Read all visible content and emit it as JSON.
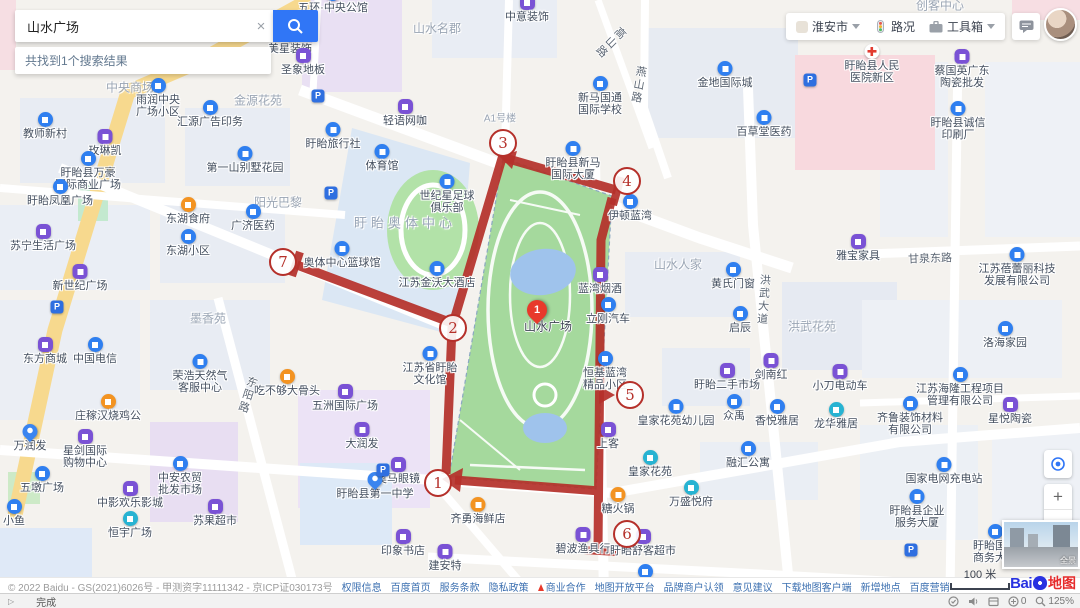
{
  "search": {
    "query": "山水广场",
    "clear_icon": "×",
    "results_text": "共找到1个搜索结果"
  },
  "topbar": {
    "city": "淮安市",
    "traffic_label": "路况",
    "toolbox_label": "工具箱"
  },
  "controls": {
    "zoom_in": "+",
    "zoom_out": "−",
    "scale_label": "100 米",
    "pano_label": "全景"
  },
  "logo": {
    "bai": "Bai",
    "ditu": "地图"
  },
  "map": {
    "pin": {
      "n": "1",
      "label": "山水广场"
    },
    "pois": [
      {
        "x": 333,
        "y": 7,
        "l": [
          "五环·中央公馆"
        ],
        "ic": "b"
      },
      {
        "x": 296,
        "y": 36,
        "l": [
          "皇家门窗"
        ],
        "ic": "t"
      },
      {
        "x": 527,
        "y": 16,
        "l": [
          "中意装饰"
        ],
        "ic": "p"
      },
      {
        "x": 290,
        "y": 48,
        "l": [
          "美星装饰"
        ],
        "ic": "p"
      },
      {
        "x": 303,
        "y": 69,
        "l": [
          "圣象地板"
        ],
        "ic": "p"
      },
      {
        "x": 158,
        "y": 99,
        "l": [
          "雨润中央",
          "广场小区"
        ],
        "ic": "b"
      },
      {
        "x": 210,
        "y": 121,
        "l": [
          "汇源广告印务"
        ],
        "ic": "b"
      },
      {
        "x": 45,
        "y": 133,
        "l": [
          "教师新村"
        ],
        "ic": "b"
      },
      {
        "x": 105,
        "y": 150,
        "l": [
          "玫琳凯"
        ],
        "ic": "p"
      },
      {
        "x": 88,
        "y": 172,
        "l": [
          "盱眙县万豪",
          "国际商业广场"
        ],
        "ic": "b"
      },
      {
        "x": 245,
        "y": 167,
        "l": [
          "第一山别墅花园"
        ],
        "ic": "b"
      },
      {
        "x": 60,
        "y": 200,
        "l": [
          "盱眙凤凰广场"
        ],
        "ic": "b"
      },
      {
        "x": 188,
        "y": 218,
        "l": [
          "东湖食府"
        ],
        "ic": "o"
      },
      {
        "x": 253,
        "y": 225,
        "l": [
          "广济医药"
        ],
        "ic": "b"
      },
      {
        "x": 43,
        "y": 245,
        "l": [
          "苏宁生活广场"
        ],
        "ic": "p"
      },
      {
        "x": 188,
        "y": 250,
        "l": [
          "东湖小区"
        ],
        "ic": "b"
      },
      {
        "x": 80,
        "y": 285,
        "l": [
          "新世纪广场"
        ],
        "ic": "p"
      },
      {
        "x": 45,
        "y": 358,
        "l": [
          "东方商城"
        ],
        "ic": "p"
      },
      {
        "x": 95,
        "y": 358,
        "l": [
          "中国电信"
        ],
        "ic": "b"
      },
      {
        "x": 200,
        "y": 375,
        "l": [
          "荣浩天然气",
          "客服中心"
        ],
        "ic": "b"
      },
      {
        "x": 287,
        "y": 390,
        "l": [
          "吃不够大骨头"
        ],
        "ic": "o"
      },
      {
        "x": 108,
        "y": 415,
        "l": [
          "庄稼汉烧鸡公"
        ],
        "ic": "o"
      },
      {
        "x": 30,
        "y": 445,
        "l": [
          "万润发"
        ],
        "ic": "pin"
      },
      {
        "x": 85,
        "y": 450,
        "l": [
          "星剑国际",
          "购物中心"
        ],
        "ic": "p"
      },
      {
        "x": 180,
        "y": 477,
        "l": [
          "中安农贸",
          "批发市场"
        ],
        "ic": "b"
      },
      {
        "x": 42,
        "y": 487,
        "l": [
          "五墩广场"
        ],
        "ic": "b"
      },
      {
        "x": 14,
        "y": 520,
        "l": [
          "小鱼"
        ],
        "ic": "b"
      },
      {
        "x": 130,
        "y": 502,
        "l": [
          "中影欢乐影城"
        ],
        "ic": "p"
      },
      {
        "x": 215,
        "y": 520,
        "l": [
          "苏果超市"
        ],
        "ic": "p"
      },
      {
        "x": 130,
        "y": 532,
        "l": [
          "恒宇广场"
        ],
        "ic": "t"
      },
      {
        "x": 362,
        "y": 443,
        "l": [
          "大润发"
        ],
        "ic": "p"
      },
      {
        "x": 398,
        "y": 478,
        "l": [
          "奥马眼镜"
        ],
        "ic": "p"
      },
      {
        "x": 375,
        "y": 493,
        "l": [
          "盱眙县第一中学"
        ],
        "ic": "pin"
      },
      {
        "x": 478,
        "y": 518,
        "l": [
          "齐勇海鲜店"
        ],
        "ic": "o"
      },
      {
        "x": 403,
        "y": 550,
        "l": [
          "印象书店"
        ],
        "ic": "p"
      },
      {
        "x": 445,
        "y": 565,
        "l": [
          "建安特"
        ],
        "ic": "p"
      },
      {
        "x": 583,
        "y": 548,
        "l": [
          "碧波渔具行"
        ],
        "ic": "p"
      },
      {
        "x": 643,
        "y": 550,
        "l": [
          "盱眙舒客超市"
        ],
        "ic": "p"
      },
      {
        "x": 691,
        "y": 501,
        "l": [
          "万盛悦府"
        ],
        "ic": "t"
      },
      {
        "x": 650,
        "y": 471,
        "l": [
          "皇家花苑"
        ],
        "ic": "t"
      },
      {
        "x": 676,
        "y": 420,
        "l": [
          "皇家花苑幼儿园"
        ],
        "ic": "b"
      },
      {
        "x": 734,
        "y": 415,
        "l": [
          "众禹"
        ],
        "ic": "b"
      },
      {
        "x": 777,
        "y": 420,
        "l": [
          "香悦雅居"
        ],
        "ic": "b"
      },
      {
        "x": 836,
        "y": 423,
        "l": [
          "龙华雅居"
        ],
        "ic": "t"
      },
      {
        "x": 748,
        "y": 462,
        "l": [
          "融汇公寓"
        ],
        "ic": "b"
      },
      {
        "x": 608,
        "y": 443,
        "l": [
          "上客"
        ],
        "ic": "p"
      },
      {
        "x": 618,
        "y": 508,
        "l": [
          "糖火锅"
        ],
        "ic": "o"
      },
      {
        "x": 727,
        "y": 384,
        "l": [
          "盱眙二手市场"
        ],
        "ic": "p"
      },
      {
        "x": 771,
        "y": 374,
        "l": [
          "剑南红"
        ],
        "ic": "p"
      },
      {
        "x": 840,
        "y": 385,
        "l": [
          "小刀电动车"
        ],
        "ic": "p"
      },
      {
        "x": 740,
        "y": 327,
        "l": [
          "启辰"
        ],
        "ic": "b"
      },
      {
        "x": 733,
        "y": 283,
        "l": [
          "黄氏门窗"
        ],
        "ic": "b"
      },
      {
        "x": 858,
        "y": 255,
        "l": [
          "雅宝家具"
        ],
        "ic": "p"
      },
      {
        "x": 1005,
        "y": 342,
        "l": [
          "洛海家园"
        ],
        "ic": "b"
      },
      {
        "x": 960,
        "y": 388,
        "l": [
          "江苏海隆工程项目",
          "管理有限公司"
        ],
        "ic": "b"
      },
      {
        "x": 910,
        "y": 417,
        "l": [
          "齐鲁装饰材料",
          "有限公司"
        ],
        "ic": "b"
      },
      {
        "x": 1010,
        "y": 418,
        "l": [
          "星悦陶瓷"
        ],
        "ic": "p"
      },
      {
        "x": 944,
        "y": 478,
        "l": [
          "国家电网充电站"
        ],
        "ic": "b"
      },
      {
        "x": 917,
        "y": 510,
        "l": [
          "盱眙县企业",
          "服务大厦"
        ],
        "ic": "b"
      },
      {
        "x": 995,
        "y": 545,
        "l": [
          "盱眙国际",
          "商务大厦"
        ],
        "ic": "b"
      },
      {
        "x": 1017,
        "y": 268,
        "l": [
          "江苏蓓蕾丽科技",
          "发展有限公司"
        ],
        "ic": "b"
      },
      {
        "x": 962,
        "y": 70,
        "l": [
          "蔡国英广东",
          "陶瓷批发"
        ],
        "ic": "p"
      },
      {
        "x": 958,
        "y": 122,
        "l": [
          "盱眙县诚信",
          "印刷厂"
        ],
        "ic": "b"
      },
      {
        "x": 872,
        "y": 65,
        "l": [
          "盱眙县人民",
          "医院新区"
        ],
        "ic": "h"
      },
      {
        "x": 725,
        "y": 82,
        "l": [
          "金地国际城"
        ],
        "ic": "b"
      },
      {
        "x": 764,
        "y": 131,
        "l": [
          "百草堂医药"
        ],
        "ic": "b"
      },
      {
        "x": 573,
        "y": 162,
        "l": [
          "盱眙县新马",
          "国际大厦"
        ],
        "ic": "b"
      },
      {
        "x": 630,
        "y": 215,
        "l": [
          "伊顿蓝湾"
        ],
        "ic": "b"
      },
      {
        "x": 600,
        "y": 97,
        "l": [
          "新马国通",
          "国际学校"
        ],
        "ic": "b"
      },
      {
        "x": 405,
        "y": 120,
        "l": [
          "轻语网咖"
        ],
        "ic": "p"
      },
      {
        "x": 333,
        "y": 143,
        "l": [
          "盱眙旅行社"
        ],
        "ic": "b"
      },
      {
        "x": 382,
        "y": 165,
        "l": [
          "体育馆"
        ],
        "ic": "b"
      },
      {
        "x": 447,
        "y": 195,
        "l": [
          "世纪星足球",
          "俱乐部"
        ],
        "ic": "b"
      },
      {
        "x": 342,
        "y": 262,
        "l": [
          "奥体中心篮球馆"
        ],
        "ic": "b"
      },
      {
        "x": 437,
        "y": 282,
        "l": [
          "江苏金沃大酒店"
        ],
        "ic": "b"
      },
      {
        "x": 430,
        "y": 367,
        "l": [
          "江苏省盱眙",
          "文化馆"
        ],
        "ic": "b"
      },
      {
        "x": 345,
        "y": 405,
        "l": [
          "五洲国际广场"
        ],
        "ic": "p"
      },
      {
        "x": 608,
        "y": 318,
        "l": [
          "立刚汽车"
        ],
        "ic": "b"
      },
      {
        "x": 600,
        "y": 288,
        "l": [
          "蓝湾烟酒"
        ],
        "ic": "p"
      },
      {
        "x": 605,
        "y": 372,
        "l": [
          "恒基蓝湾",
          "精品小区"
        ],
        "ic": "b"
      },
      {
        "x": 645,
        "y": 585,
        "l": [
          "瑞天家园"
        ],
        "ic": "b"
      }
    ],
    "areas": [
      {
        "x": 437,
        "y": 28,
        "t": "山水名郡"
      },
      {
        "x": 940,
        "y": 5,
        "t": "创客中心"
      },
      {
        "x": 130,
        "y": 87,
        "t": "中央商场"
      },
      {
        "x": 258,
        "y": 100,
        "t": "金源花苑"
      },
      {
        "x": 278,
        "y": 202,
        "t": "阳光巴黎"
      },
      {
        "x": 208,
        "y": 318,
        "t": "墨香苑"
      },
      {
        "x": 678,
        "y": 264,
        "t": "山水人家"
      },
      {
        "x": 812,
        "y": 326,
        "t": "洪武花苑"
      },
      {
        "x": 405,
        "y": 222,
        "t": "盱眙奥体中心",
        "big": true
      },
      {
        "x": 500,
        "y": 117,
        "t": "A1号楼",
        "small": true
      }
    ],
    "road_labels": [
      {
        "x": 247,
        "y": 395,
        "t": "东阳路",
        "v": true,
        "tilt": 18
      },
      {
        "x": 763,
        "y": 300,
        "t": "洪武大道",
        "v": true,
        "tilt": 4
      },
      {
        "x": 638,
        "y": 85,
        "t": "燕山路",
        "v": true,
        "tilt": 10
      },
      {
        "x": 610,
        "y": 42,
        "t": "高山路",
        "v": true,
        "tilt": 45
      },
      {
        "x": 930,
        "y": 258,
        "t": "甘泉东路",
        "v": false,
        "tilt": -2
      }
    ],
    "parkings": [
      [
        318,
        96
      ],
      [
        331,
        193
      ],
      [
        57,
        307
      ],
      [
        810,
        80
      ],
      [
        383,
        470
      ],
      [
        911,
        550
      ]
    ]
  },
  "annotation": {
    "markers": [
      {
        "n": "1",
        "x": 438,
        "y": 483
      },
      {
        "n": "2",
        "x": 453,
        "y": 328
      },
      {
        "n": "3",
        "x": 503,
        "y": 143
      },
      {
        "n": "4",
        "x": 627,
        "y": 181
      },
      {
        "n": "5",
        "x": 630,
        "y": 395
      },
      {
        "n": "6",
        "x": 627,
        "y": 534
      },
      {
        "n": "7",
        "x": 283,
        "y": 262
      }
    ]
  },
  "footer": {
    "copyright": "© 2022 Baidu - GS(2021)6026号 - 甲测资字11111342 - 京ICP证030173号",
    "links": [
      {
        "t": "权限信息"
      },
      {
        "t": "百度首页"
      },
      {
        "t": "服务条款"
      },
      {
        "t": "隐私政策"
      },
      {
        "t": "商业合作",
        "flame": true
      },
      {
        "t": "地图开放平台"
      },
      {
        "t": "品牌商户认领"
      },
      {
        "t": "意见建议"
      },
      {
        "t": "下载地图客户端"
      },
      {
        "t": "新增地点"
      },
      {
        "t": "百度营销"
      }
    ]
  },
  "statusbar": {
    "status_text": "完成",
    "count": "0",
    "zoom_level": "125%"
  }
}
